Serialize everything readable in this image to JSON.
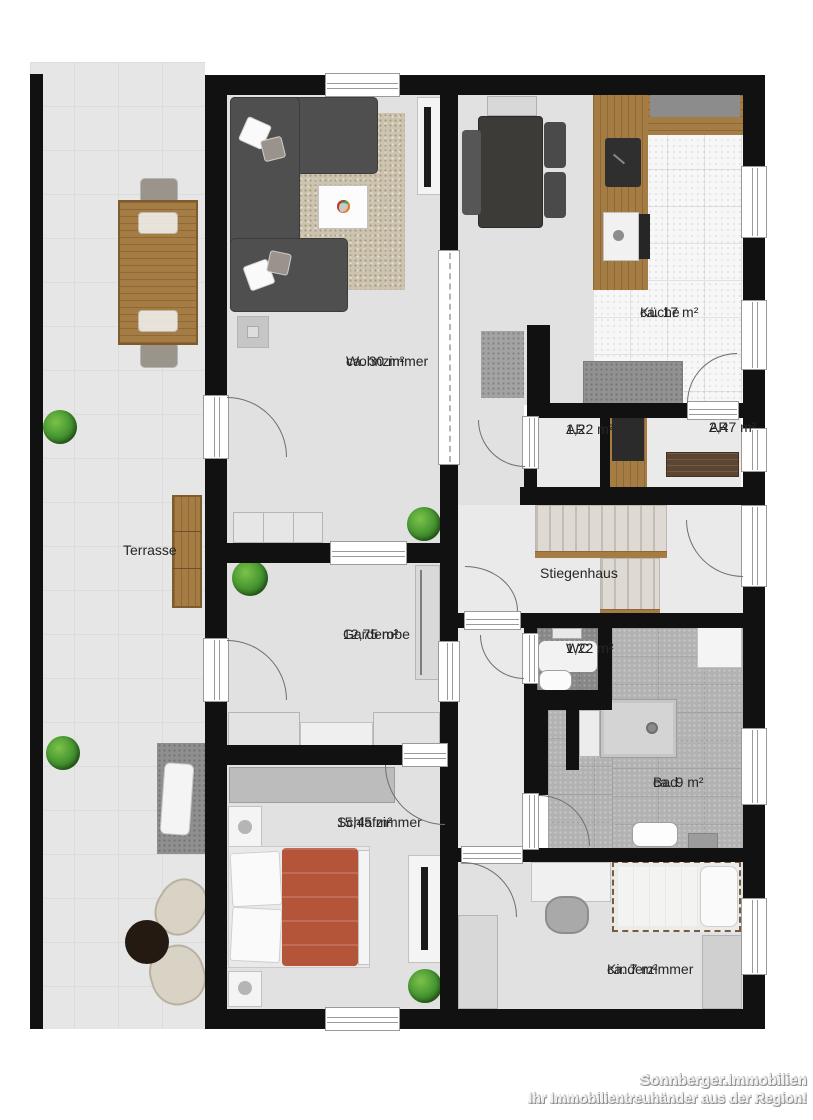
{
  "rooms": [
    {
      "id": "terrasse",
      "label": "Terrasse",
      "area": ""
    },
    {
      "id": "wohnzimmer",
      "label": "Wohnzimmer",
      "area": "ca. 30 m²"
    },
    {
      "id": "kueche",
      "label": "Küche",
      "area": "ca. 17 m²"
    },
    {
      "id": "ar1",
      "label": "AR",
      "area": "1,22 m²"
    },
    {
      "id": "ar2",
      "label": "AR",
      "area": "2,47 m²"
    },
    {
      "id": "stiegenhaus",
      "label": "Stiegenhaus",
      "area": ""
    },
    {
      "id": "garderobe",
      "label": "Garderobe",
      "area": "12,75 m²"
    },
    {
      "id": "wc",
      "label": "WC",
      "area": "1,22 m²"
    },
    {
      "id": "bad",
      "label": "Bad",
      "area": "ca. 9 m²"
    },
    {
      "id": "schlafzimmer",
      "label": "Schlafzimmer",
      "area": "15,45 m²"
    },
    {
      "id": "kinderzimmer",
      "label": "Kinderzimmer",
      "area": "ca. 7 m²"
    }
  ],
  "watermark": {
    "line1": "Sonnberger.Immobilien",
    "line2": "Ihr Immobilientreuhänder aus der Region!"
  },
  "colors": {
    "wall": "#111111",
    "terrace_floor": "#e6e6e6",
    "room_floor": "#e1e1e1",
    "kitchen_tile": "#f7f7f7",
    "bath_tile": "#b2b2b2",
    "wc_tile": "#878787",
    "wood": "#a57c44",
    "sofa_gray": "#4f4f4f",
    "bed_red": "#b4553a",
    "plant_green": "#4a9a33",
    "counter_gray": "#919191",
    "bench_brown": "#5c4632",
    "door_arc": "#6f6f6f"
  },
  "furniture": {
    "terrasse": [
      "outdoor-dining-table",
      "outdoor-chairs",
      "garden-bench",
      "plants",
      "outdoor-mat",
      "sun-lounger",
      "lounge-armchairs",
      "round-side-table"
    ],
    "wohnzimmer": [
      "corner-sofa",
      "throw-pillows",
      "rug",
      "coffee-table",
      "fruit-bowl",
      "tv-board",
      "tv",
      "cabinet",
      "lowboard",
      "plant"
    ],
    "kueche": [
      "dining-table",
      "chairs",
      "bench",
      "l-shaped-counter",
      "sink",
      "stove",
      "kitchen-island",
      "sideboard"
    ],
    "abstellraum": [
      "utility-cabinet",
      "wooden-bench"
    ],
    "stiegenhaus": [
      "staircase"
    ],
    "garderobe": [
      "wardrobe",
      "sideboards",
      "bench",
      "plant"
    ],
    "wc": [
      "toilet",
      "hand-basin"
    ],
    "bad": [
      "shower",
      "washing-machine",
      "bathroom-sink",
      "stool"
    ],
    "schlafzimmer": [
      "wardrobe",
      "double-bed",
      "nightstands",
      "lamps",
      "tv-board",
      "tv",
      "plant"
    ],
    "kinderzimmer": [
      "desk",
      "desk-chair",
      "single-bed",
      "pillow",
      "dressers"
    ]
  }
}
